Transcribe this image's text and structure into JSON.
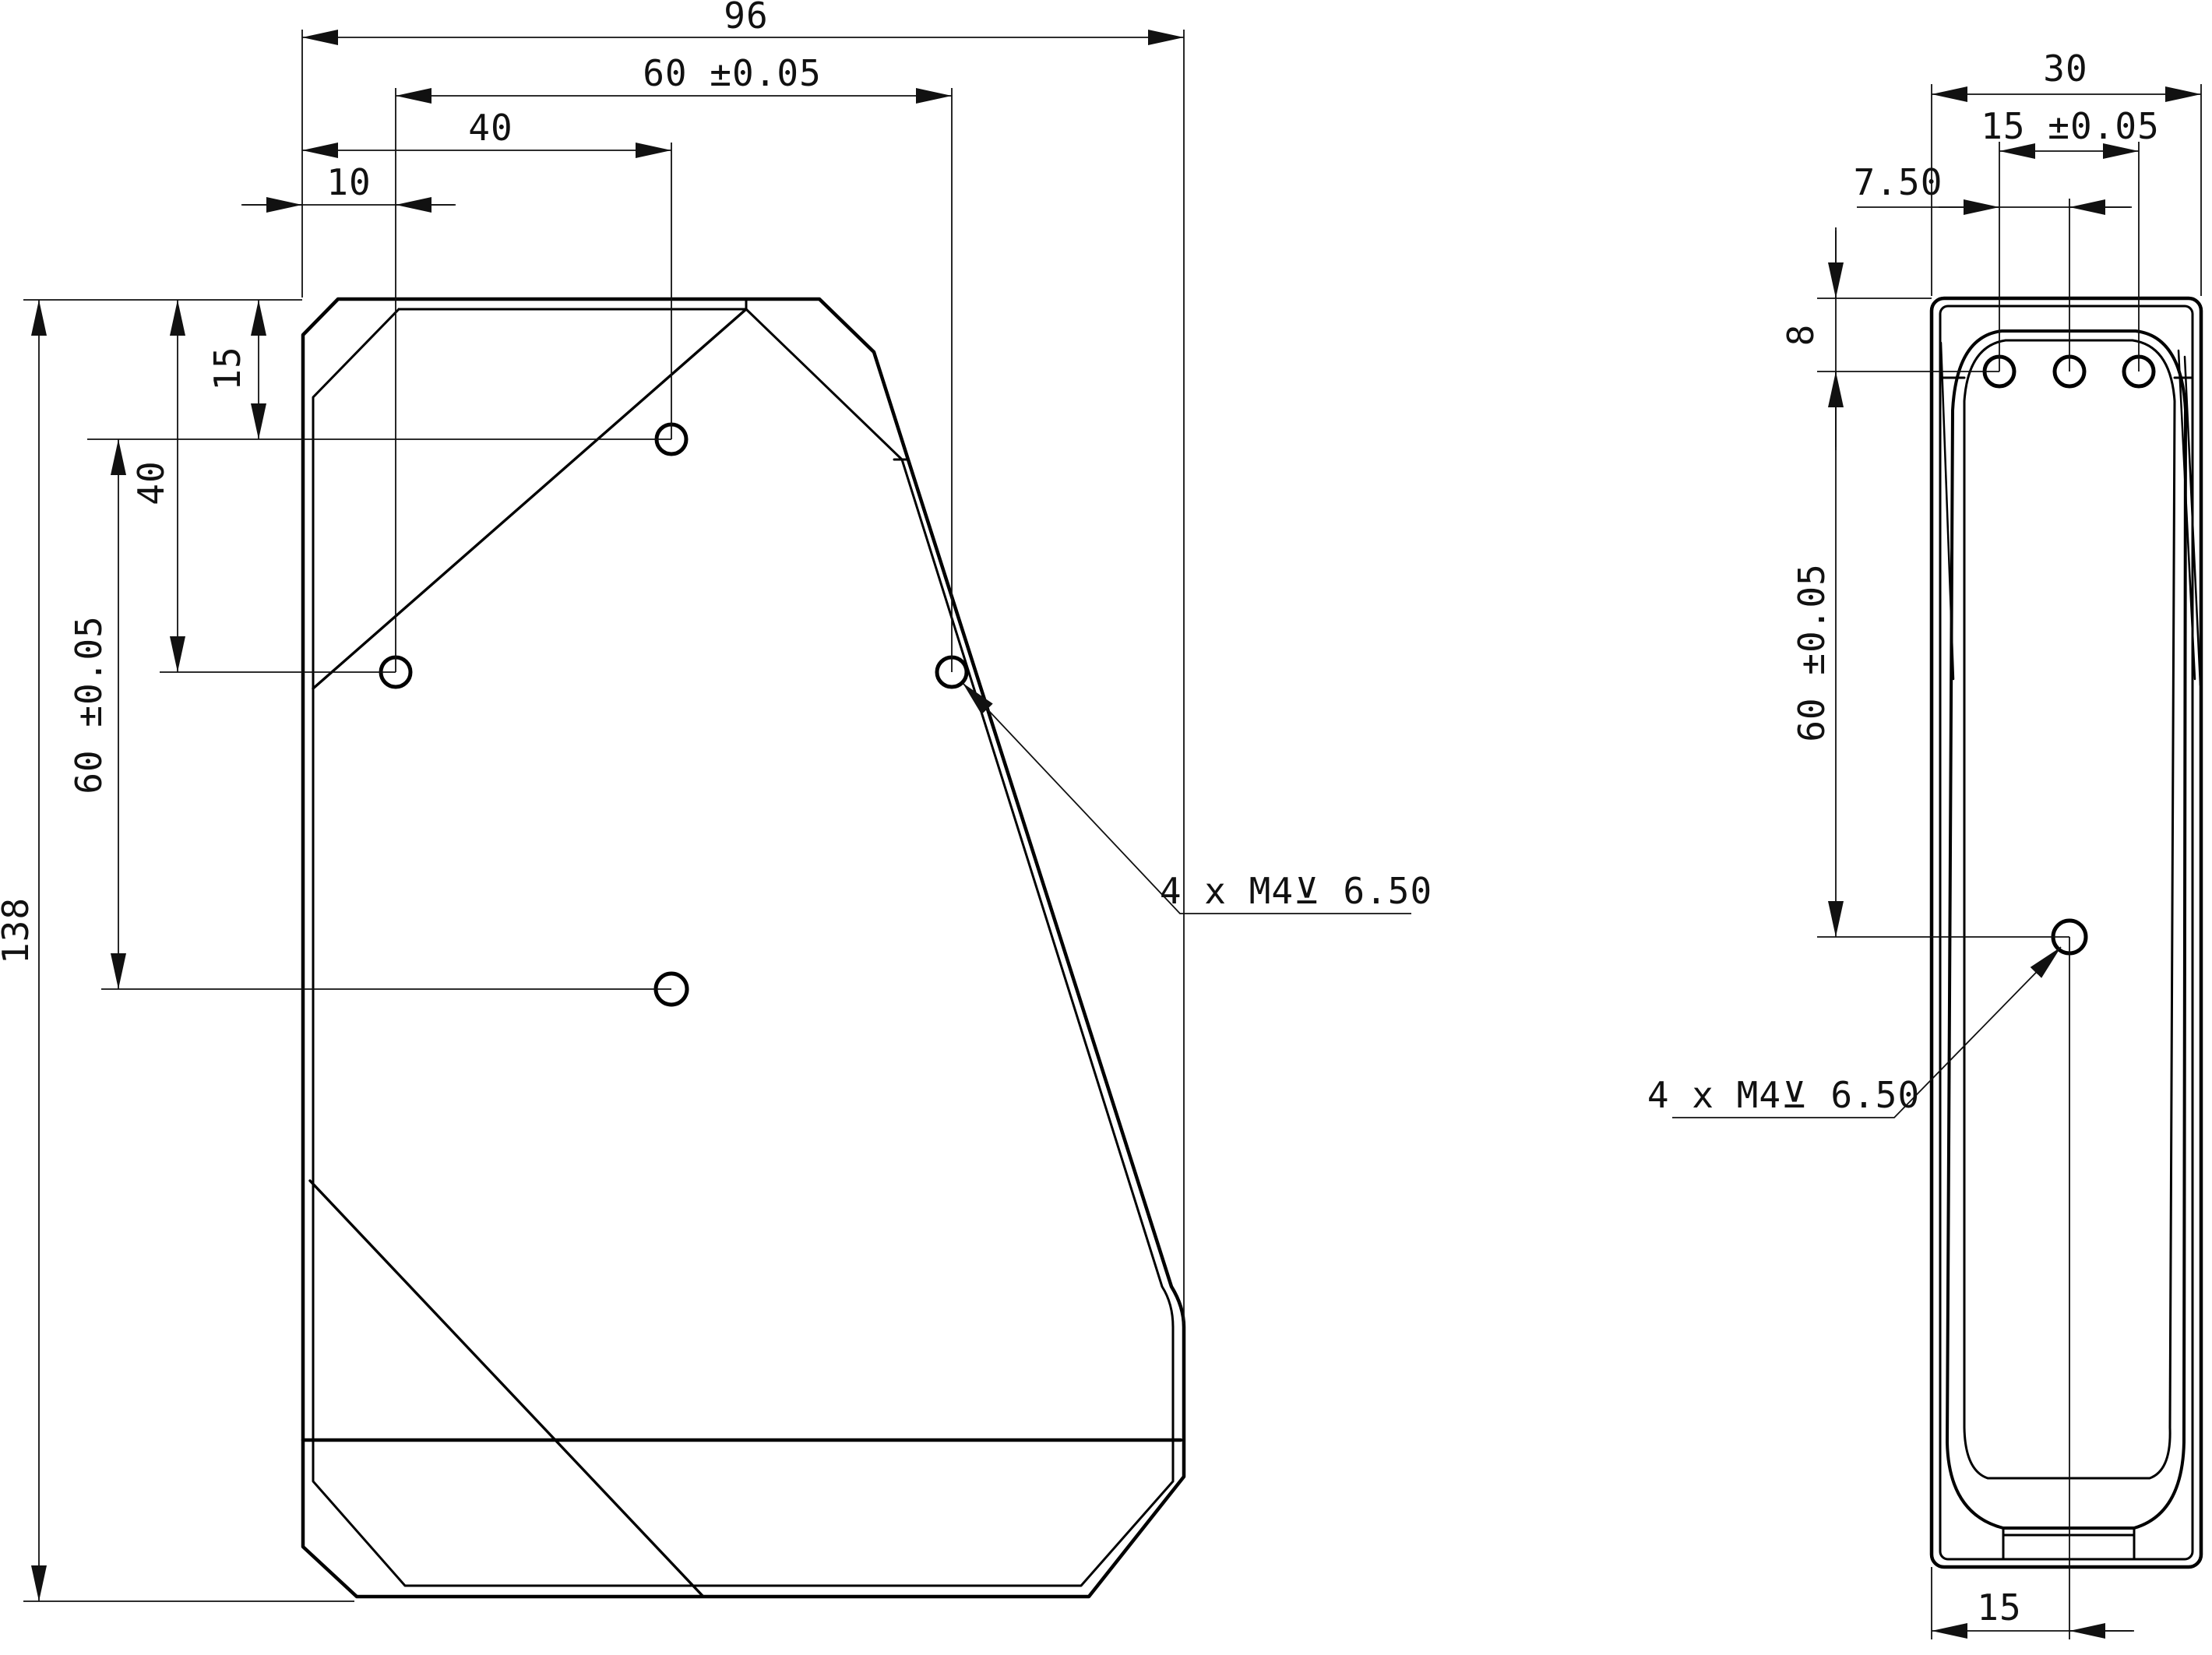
{
  "drawing": {
    "type": "engineering-drawing",
    "colors": {
      "line": "#000000",
      "background": "#ffffff"
    },
    "front_view": {
      "dims": {
        "total_width": "96",
        "hole_span_width": "60 ±0.05",
        "top_hole_offset": "40",
        "left_hole_offset": "10",
        "top_hole_height": "15",
        "left_hole_height": "40",
        "hole_span_height": "60 ±0.05",
        "total_height": "138",
        "thread_note": "4 x M4⊻ 6.50"
      }
    },
    "side_view": {
      "dims": {
        "total_depth": "30",
        "hole_spacing": "15 ±0.05",
        "middle_hole_offset": "7.50",
        "top_edge_offset": "8",
        "hole_span_height": "60 ±0.05",
        "thread_note": "4 x M4⊻ 6.50",
        "bottom_hole_offset": "15"
      }
    }
  }
}
